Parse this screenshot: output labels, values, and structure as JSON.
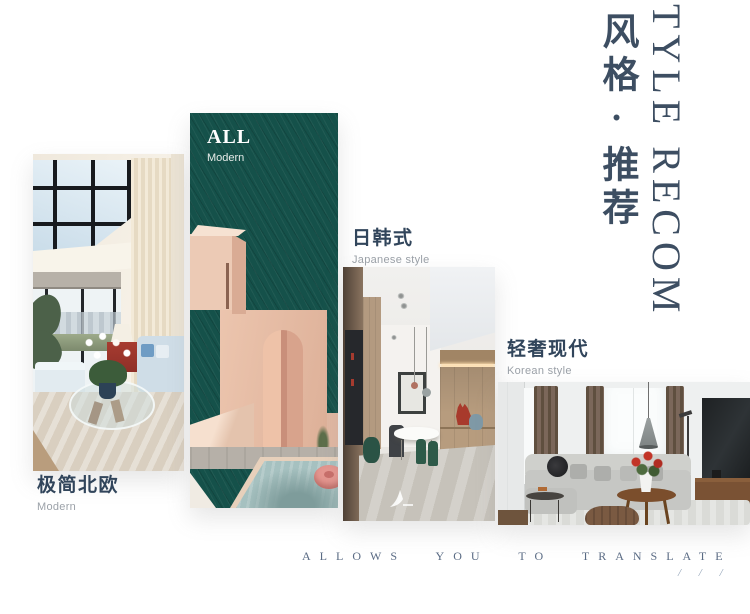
{
  "header": {
    "title_cn": "风格·推荐",
    "title_en": "TYLE RECOM",
    "title_color": "#3d4e62"
  },
  "styles": [
    {
      "name_cn": "极简北欧",
      "name_en": "Modern",
      "image": "nordic-minimalist-living-room-photo"
    },
    {
      "badge": "ALL",
      "badge_sub": "Modern",
      "bg": "#15514a",
      "image": "green-card-arch-pool-graphic"
    },
    {
      "name_cn": "日韩式",
      "name_en": "Japanese style",
      "image": "japanese-style-hallway-photo"
    },
    {
      "name_cn": "轻奢现代",
      "name_en": "Korean style",
      "image": "korean-modern-living-room-photo"
    }
  ],
  "footer": {
    "tagline": "ALLOWS YOU TO TRANSLATE",
    "marks": "/ / /"
  },
  "watermark": {
    "icon": "designer-logo-watermark-icon"
  }
}
